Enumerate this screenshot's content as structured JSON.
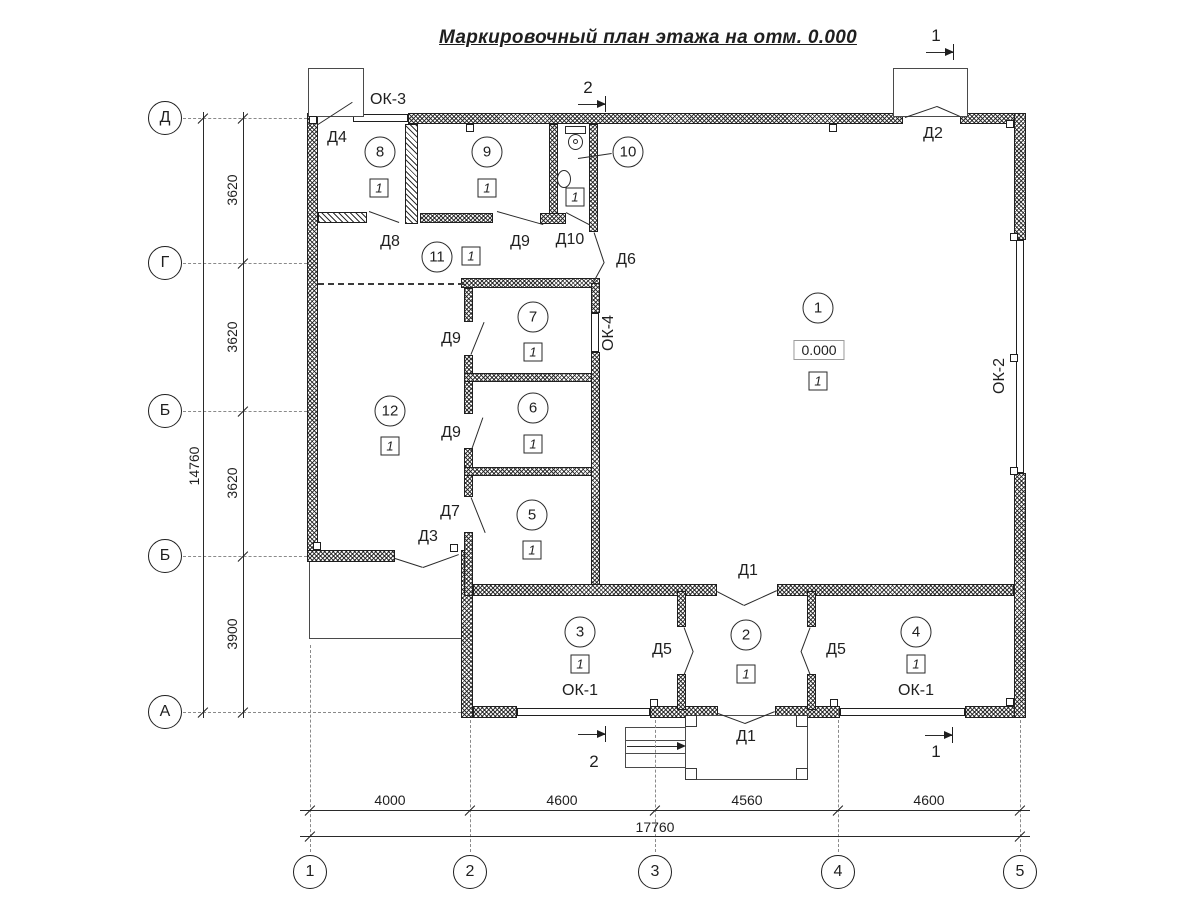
{
  "title": "Маркировочный план этажа на отм. 0.000",
  "grid": {
    "rows": [
      {
        "label": "Д"
      },
      {
        "label": "Г"
      },
      {
        "label": "Б"
      },
      {
        "label": "Б"
      },
      {
        "label": "А"
      }
    ],
    "cols": [
      {
        "label": "1"
      },
      {
        "label": "2"
      },
      {
        "label": "3"
      },
      {
        "label": "4"
      },
      {
        "label": "5"
      }
    ]
  },
  "dims": {
    "left_segments": [
      "3620",
      "3620",
      "3620",
      "3900"
    ],
    "left_total": "14760",
    "bottom_segments": [
      "4000",
      "4600",
      "4560",
      "4600"
    ],
    "bottom_total": "17760"
  },
  "rooms": [
    {
      "number": "1",
      "badge": "1",
      "elevation": "0.000"
    },
    {
      "number": "2",
      "badge": "1"
    },
    {
      "number": "3",
      "badge": "1"
    },
    {
      "number": "4",
      "badge": "1"
    },
    {
      "number": "5",
      "badge": "1"
    },
    {
      "number": "6",
      "badge": "1"
    },
    {
      "number": "7",
      "badge": "1"
    },
    {
      "number": "8",
      "badge": "1"
    },
    {
      "number": "9",
      "badge": "1"
    },
    {
      "number": "10",
      "badge": "1"
    },
    {
      "number": "11",
      "badge": "1"
    },
    {
      "number": "12",
      "badge": "1"
    }
  ],
  "doors": {
    "d1_top": "Д1",
    "d1_bottom": "Д1",
    "d2": "Д2",
    "d3": "Д3",
    "d4": "Д4",
    "d5_left": "Д5",
    "d5_right": "Д5",
    "d6": "Д6",
    "d7": "Д7",
    "d8": "Д8",
    "d9_room9": "Д9",
    "d9_room7": "Д9",
    "d9_room6": "Д9",
    "d10": "Д10"
  },
  "windows": {
    "ok1_left": "ОК-1",
    "ok1_right": "ОК-1",
    "ok2": "ОК-2",
    "ok3": "ОК-3",
    "ok4": "ОК-4"
  },
  "sections": {
    "top_1": "1",
    "top_2": "2",
    "bottom_1": "1",
    "bottom_2": "2"
  }
}
